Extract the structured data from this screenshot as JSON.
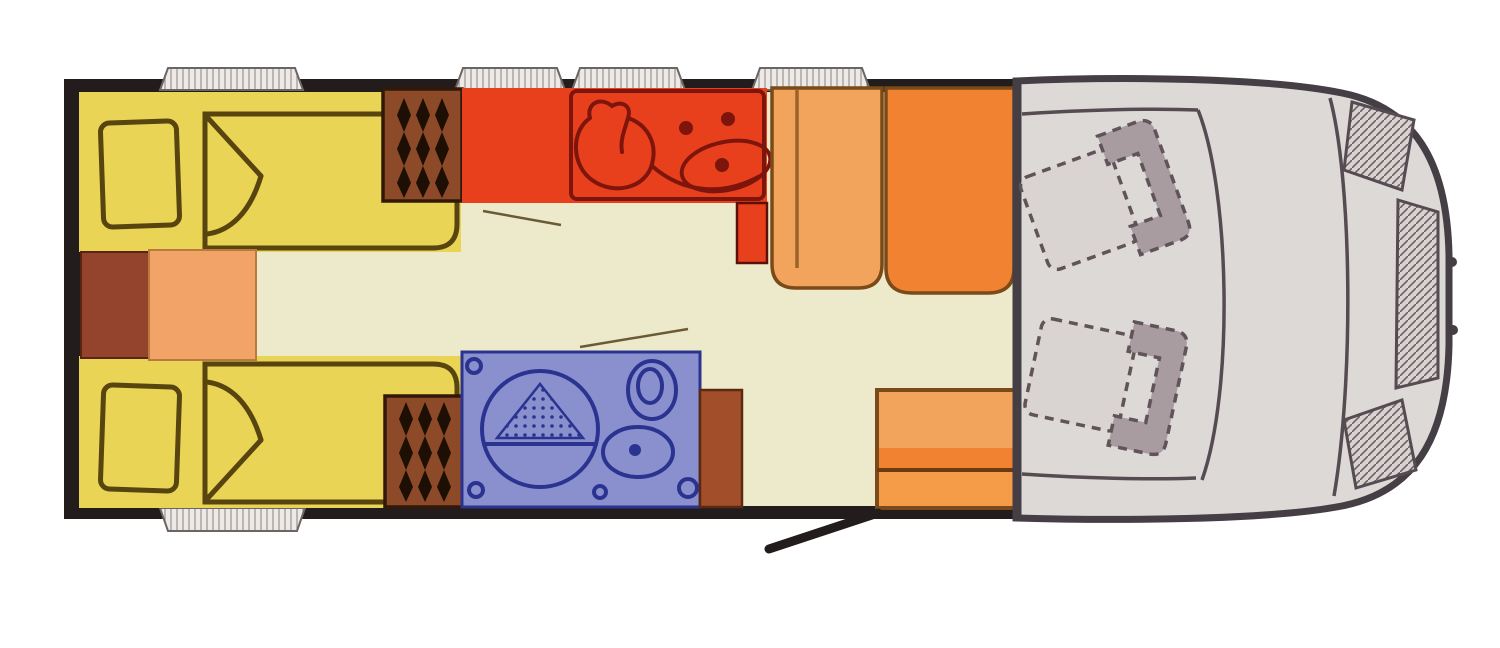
{
  "document": {
    "kind": "motorhome-floor-plan",
    "orientation": "rear-at-left-cab-at-right",
    "visible_text": []
  },
  "palette": {
    "wall": "#231c1c",
    "floor": "#edeacb",
    "bed": "#e9d455",
    "bedline": "#57440f",
    "cabinet": "#94432c",
    "sideboard": "#f2a468",
    "wardrobe": "#8c4a28",
    "kitchen": "#e8401c",
    "kitchenline": "#7e150c",
    "benchlight": "#f3a45c",
    "benchdark": "#f08232",
    "benchlow": "#f49c48",
    "bath": "#8a90ce",
    "bathline": "#2a3390",
    "brownblock": "#a24e2a",
    "cab": "#ddd9d7",
    "cabline": "#453e44",
    "seatlight": "#d9d3d1",
    "seatdark": "#a89ca1",
    "window": "#ece9e6",
    "paper": "#ffffff"
  },
  "areas": [
    {
      "id": "rear-bedroom",
      "icon": "twin-beds-icon",
      "color": "#e9d455"
    },
    {
      "id": "bedside-cabinet",
      "icon": "cabinet-icon",
      "color": "#94432c"
    },
    {
      "id": "bedside-sideboard",
      "icon": "sideboard-icon",
      "color": "#f2a468"
    },
    {
      "id": "wardrobe-top",
      "icon": "hanging-clothes-icon",
      "color": "#8c4a28"
    },
    {
      "id": "wardrobe-bottom",
      "icon": "hanging-clothes-icon",
      "color": "#8c4a28"
    },
    {
      "id": "kitchen",
      "icon": "sink-and-hob-icon",
      "color": "#e8401c"
    },
    {
      "id": "dinette-benches",
      "icon": "bench-seat-icon",
      "color": "#f08232"
    },
    {
      "id": "bathroom",
      "icon": "shower-toilet-basin-icon",
      "color": "#8a90ce"
    },
    {
      "id": "side-bench",
      "icon": "bench-seat-icon",
      "color": "#f49c48"
    },
    {
      "id": "entry-door",
      "icon": "open-door-icon",
      "color": "#231c1c"
    },
    {
      "id": "cab",
      "icon": "swivel-seats-icon",
      "color": "#ddd9d7"
    }
  ],
  "window_count": 5
}
